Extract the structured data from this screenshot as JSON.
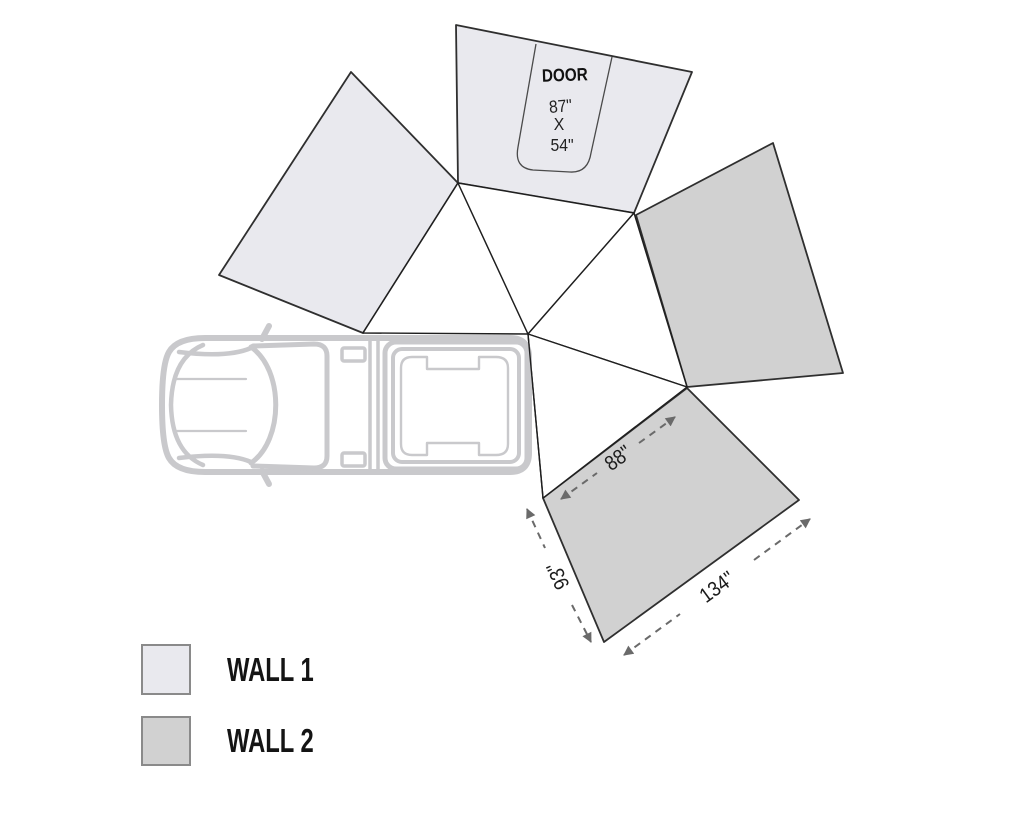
{
  "door": {
    "label": "DOOR",
    "line1": "87\"",
    "line2": "X",
    "line3": "54\""
  },
  "dimensions": {
    "wall2_top": "88\"",
    "wall2_left": "93\"",
    "wall2_bottom": "134\""
  },
  "legend": {
    "wall1_label": "WALL 1",
    "wall2_label": "WALL 2"
  },
  "colors": {
    "wall1": "#e9e9ee",
    "wall2": "#d1d1d1",
    "vehicle": "#c9c9cc",
    "dimension": "#6a6a6a",
    "swatch_border": "#8a8a8a"
  }
}
